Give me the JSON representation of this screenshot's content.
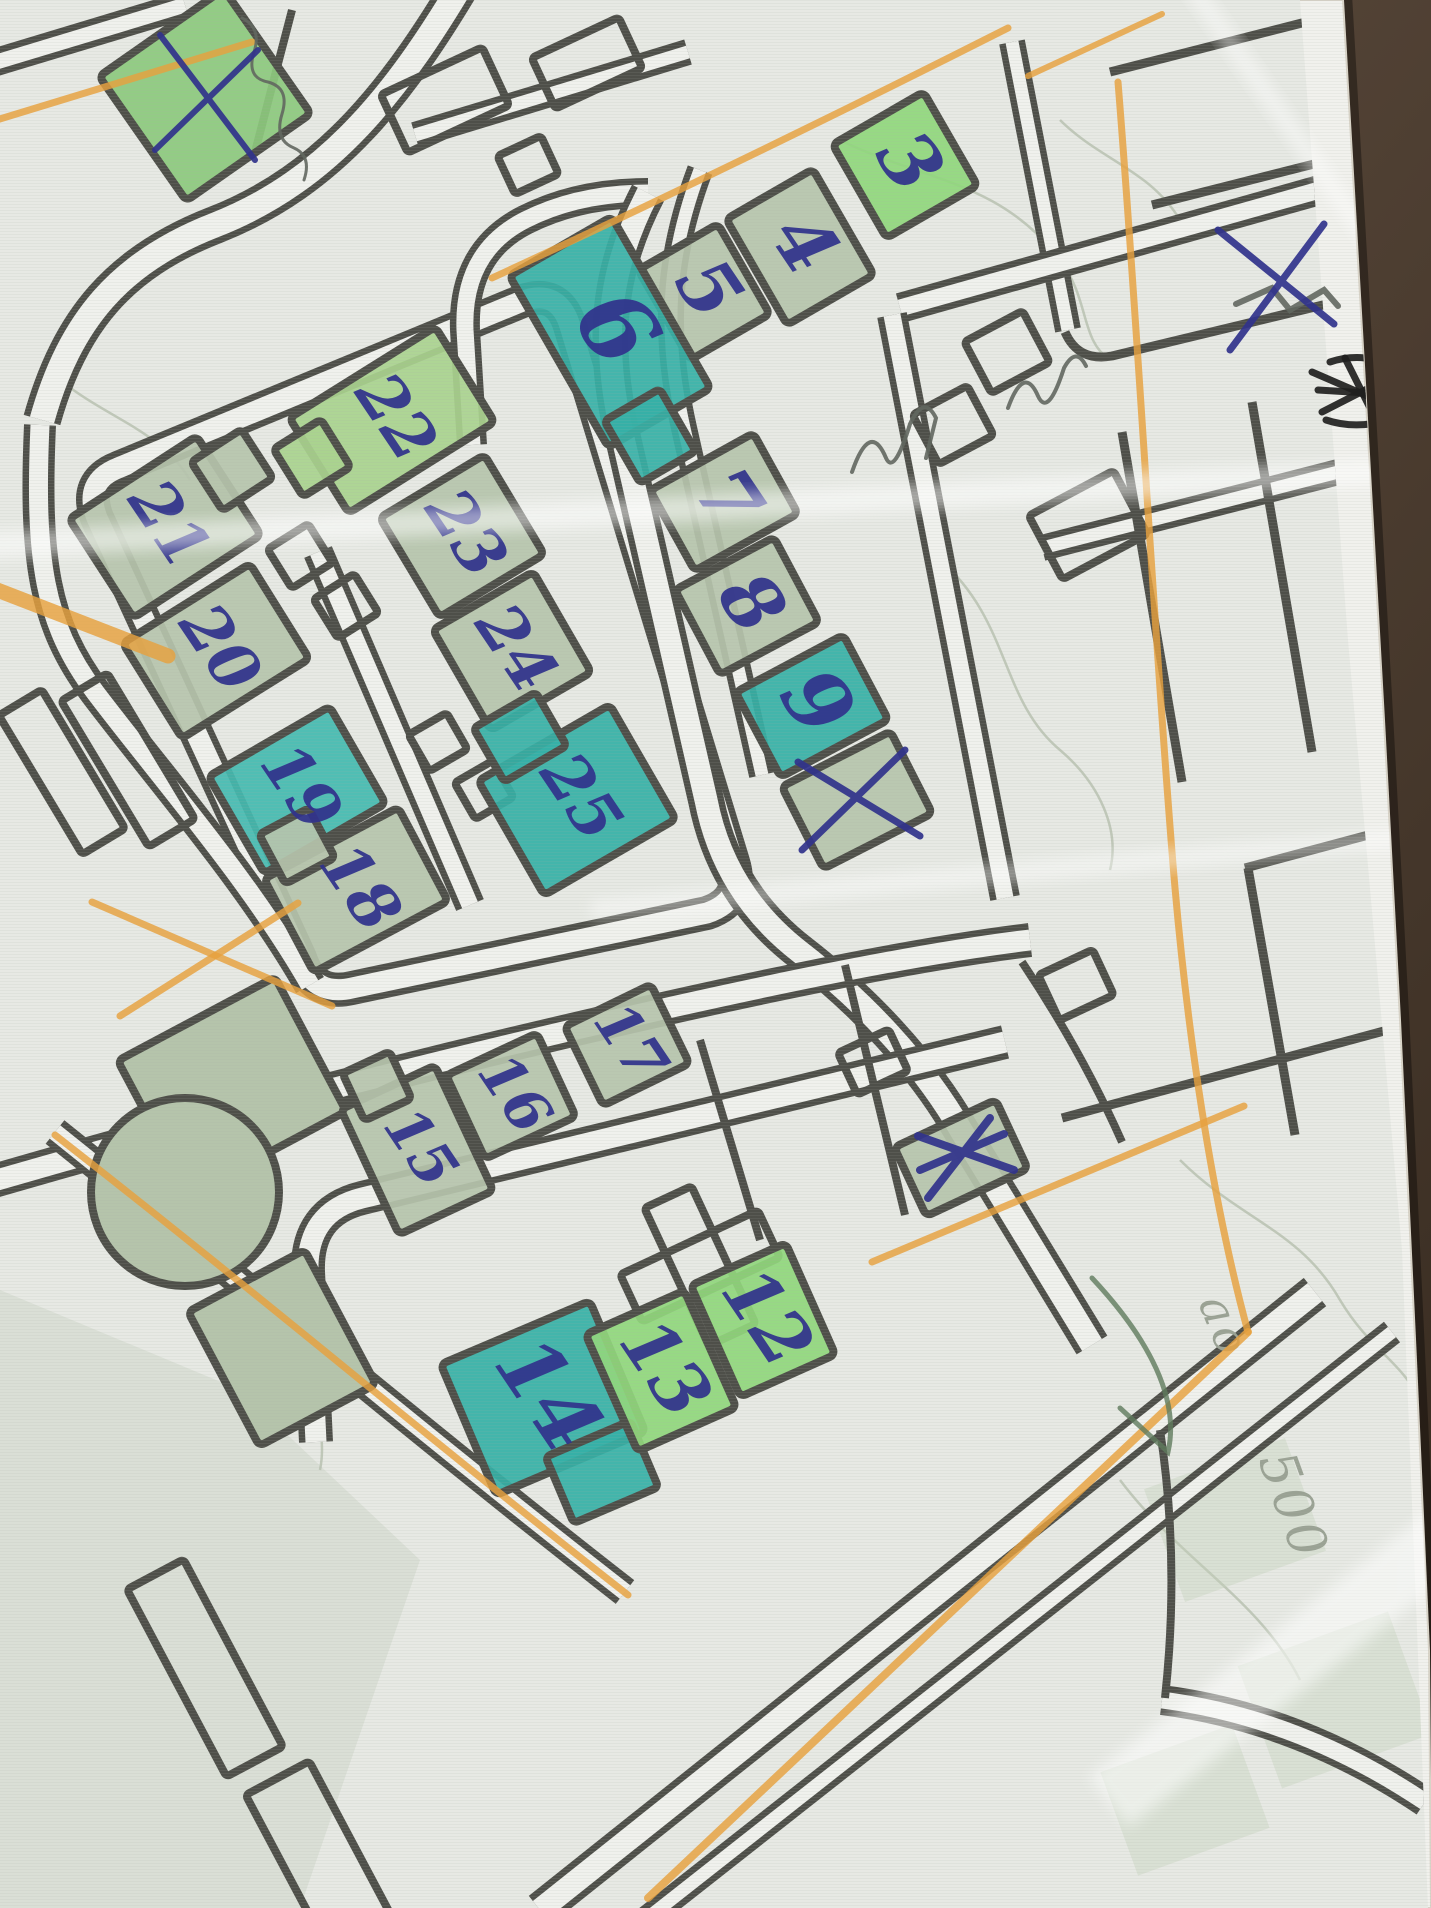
{
  "meta": {
    "description_label": ""
  },
  "scene": {
    "width": 1431,
    "height": 1908,
    "table_color_light": "#6b5849",
    "table_color_dark": "#35291e",
    "paper_color": "#f1f1ed",
    "map_bg": "#e7e9e4",
    "line_color": "#4e4f49",
    "road_fill": "#f0f1ed",
    "pen_color": "#31338c",
    "orange": "#e6a13e",
    "pencil": "#62675f",
    "print_gray": "#9aa294",
    "fills": {
      "pale": "#b6c4ac",
      "green": "#90d77c",
      "green2": "#a9d28e",
      "green3": "#8cc97d",
      "teal": "#35b0a6",
      "teal2": "#43bab0",
      "sage": "#b5c4ab"
    }
  },
  "paper_outline": "M 0,0 L 1343,0 L 1362,330 L 1384,720 L 1400,1020 L 1416,1360 L 1429,1650 L 1431,1908 L 0,1908 Z",
  "map_clip": "M 0,0 L 1300,0 L 1348,640 L 1402,1250 L 1428,1908 L 0,1908 Z",
  "roads": [
    {
      "d": "M 470,-30 C 400,90 330,180 215,225 C 120,262 70,320 42,420",
      "w": 38
    },
    {
      "d": "M -30,70 L 185,5",
      "w": 28
    },
    {
      "d": "M 118,468 L 520,302 Q 558,287 570,326 L 733,862 Q 745,900 707,913 L 352,988 Q 313,997 300,958 L 97,518 Q 83,482 118,468 Z",
      "w": 34
    },
    {
      "d": "M 318,552 L 470,905",
      "w": 30
    },
    {
      "d": "M 472,445 L 465,330 Q 462,252 525,220 Q 578,193 648,193",
      "w": 30
    },
    {
      "d": "M 648,193 C 612,262 600,330 620,425 L 706,800 Q 724,893 800,952 C 862,1000 922,1062 962,1132 L 1092,1345",
      "w": 36
    },
    {
      "d": "M 700,170 C 668,255 662,330 684,428 L 762,775",
      "w": 26
    },
    {
      "d": "M -20,1185 C 210,1118 430,1062 650,1012 C 800,978 930,952 1030,940",
      "w": 34
    },
    {
      "d": "M 316,1442 L 308,1272 Q 306,1212 362,1198 L 1005,1042",
      "w": 34
    },
    {
      "d": "M 1315,1292 L 540,1910",
      "w": 36
    },
    {
      "d": "M 1392,1332 L 640,1924",
      "w": 26
    },
    {
      "d": "M 415,135 L 688,52",
      "w": 26
    },
    {
      "d": "M 1012,42 L 1068,330",
      "w": 26
    },
    {
      "d": "M 900,308 L 1348,182",
      "w": 30
    },
    {
      "d": "M 892,315 L 1005,898",
      "w": 30
    },
    {
      "d": "M 1042,548 L 1432,448",
      "w": 26
    },
    {
      "d": "M 1162,1700 Q 1300,1718 1425,1802",
      "w": 30
    },
    {
      "d": "M 40,425 C 34,560 44,624 95,692 C 160,778 250,880 310,985",
      "w": 32
    },
    {
      "d": "M 55,1132 C 255,1292 420,1432 625,1592",
      "w": 30
    }
  ],
  "single_lines": [
    {
      "d": "M 1065,332 Q 1078,362 1112,356 L 1352,298",
      "w": 9
    },
    {
      "d": "M 1110,72 L 1345,12",
      "w": 9
    },
    {
      "d": "M 1152,205 L 1385,146",
      "w": 9
    },
    {
      "d": "M 1122,432 L 1182,782",
      "w": 9
    },
    {
      "d": "M 1252,402 L 1312,752",
      "w": 9
    },
    {
      "d": "M 1062,1118 L 1432,1018",
      "w": 9
    },
    {
      "d": "M 1245,868 L 1432,818",
      "w": 9
    },
    {
      "d": "M 1248,868 L 1295,1135",
      "w": 9
    },
    {
      "d": "M 292,10 L 255,152",
      "w": 8
    },
    {
      "d": "M 1022,962 Q 1082,1052 1122,1142",
      "w": 8
    },
    {
      "d": "M 845,965 L 905,1215",
      "w": 8
    },
    {
      "d": "M 700,1040 L 760,1240",
      "w": 8
    },
    {
      "d": "M 1160,1430 Q 1180,1560 1165,1698",
      "w": 8
    }
  ],
  "buildings": [
    {
      "label": "3",
      "cx": 905,
      "cy": 165,
      "w": 105,
      "h": 108,
      "rot": -30,
      "fill": "green",
      "lsize": 76
    },
    {
      "label": "4",
      "cx": 800,
      "cy": 247,
      "w": 100,
      "h": 122,
      "rot": -30,
      "fill": "pale",
      "lsize": 76
    },
    {
      "label": "5",
      "cx": 704,
      "cy": 292,
      "w": 92,
      "h": 104,
      "rot": -30,
      "fill": "pale",
      "lsize": 76
    },
    {
      "label": "6",
      "cx": 610,
      "cy": 332,
      "w": 118,
      "h": 198,
      "rot": -30,
      "fill": "teal",
      "lsize": 96,
      "ext": [
        {
          "cx": 650,
          "cy": 436,
          "w": 64,
          "h": 72
        }
      ]
    },
    {
      "label": "7",
      "cx": 724,
      "cy": 502,
      "w": 118,
      "h": 92,
      "rot": -29,
      "fill": "pale",
      "lsize": 76
    },
    {
      "label": "8",
      "cx": 747,
      "cy": 606,
      "w": 112,
      "h": 96,
      "rot": -28,
      "fill": "pale",
      "lsize": 76
    },
    {
      "label": "9",
      "cx": 812,
      "cy": 706,
      "w": 122,
      "h": 96,
      "rot": -28,
      "fill": "teal",
      "lsize": 84
    },
    {
      "label": "",
      "cx": 857,
      "cy": 800,
      "w": 122,
      "h": 92,
      "rot": -27,
      "fill": "pale"
    },
    {
      "label": "21",
      "cx": 165,
      "cy": 527,
      "w": 152,
      "h": 118,
      "rot": -33,
      "fill": "pale",
      "lsize": 64,
      "ext": [
        {
          "cx": 232,
          "cy": 470,
          "w": 60,
          "h": 58
        }
      ]
    },
    {
      "label": "22",
      "cx": 392,
      "cy": 420,
      "w": 172,
      "h": 112,
      "rot": -32,
      "fill": "green2",
      "lsize": 64,
      "ext": [
        {
          "cx": 312,
          "cy": 458,
          "w": 56,
          "h": 56
        }
      ]
    },
    {
      "label": "23",
      "cx": 462,
      "cy": 536,
      "w": 122,
      "h": 116,
      "rot": -31,
      "fill": "pale",
      "lsize": 64
    },
    {
      "label": "24",
      "cx": 512,
      "cy": 651,
      "w": 116,
      "h": 116,
      "rot": -30,
      "fill": "pale",
      "lsize": 64
    },
    {
      "label": "20",
      "cx": 216,
      "cy": 651,
      "w": 150,
      "h": 112,
      "rot": -32,
      "fill": "pale",
      "lsize": 64
    },
    {
      "label": "19",
      "cx": 297,
      "cy": 790,
      "w": 140,
      "h": 112,
      "rot": -30,
      "fill": "teal2",
      "lsize": 64
    },
    {
      "label": "25",
      "cx": 577,
      "cy": 800,
      "w": 152,
      "h": 132,
      "rot": -30,
      "fill": "teal",
      "lsize": 64,
      "ext": [
        {
          "cx": 520,
          "cy": 737,
          "w": 72,
          "h": 62
        }
      ]
    },
    {
      "label": "18",
      "cx": 356,
      "cy": 890,
      "w": 152,
      "h": 106,
      "rot": -28,
      "fill": "pale",
      "lsize": 64,
      "ext": [
        {
          "cx": 297,
          "cy": 846,
          "w": 56,
          "h": 56
        }
      ]
    },
    {
      "label": "17",
      "cx": 627,
      "cy": 1045,
      "w": 96,
      "h": 88,
      "rot": -26,
      "fill": "pale",
      "lsize": 58
    },
    {
      "label": "16",
      "cx": 511,
      "cy": 1096,
      "w": 100,
      "h": 92,
      "rot": -25,
      "fill": "pale",
      "lsize": 58
    },
    {
      "label": "15",
      "cx": 417,
      "cy": 1150,
      "w": 104,
      "h": 138,
      "rot": -25,
      "fill": "pale",
      "lsize": 58,
      "ext": [
        {
          "cx": 377,
          "cy": 1086,
          "w": 52,
          "h": 52
        }
      ]
    },
    {
      "label": "14",
      "cx": 543,
      "cy": 1398,
      "w": 162,
      "h": 142,
      "rot": -23,
      "fill": "teal",
      "lsize": 84,
      "ext": [
        {
          "cx": 602,
          "cy": 1472,
          "w": 92,
          "h": 72
        }
      ]
    },
    {
      "label": "13",
      "cx": 661,
      "cy": 1371,
      "w": 108,
      "h": 128,
      "rot": -24,
      "fill": "green",
      "lsize": 72
    },
    {
      "label": "12",
      "cx": 763,
      "cy": 1320,
      "w": 104,
      "h": 122,
      "rot": -24,
      "fill": "green",
      "lsize": 72
    },
    {
      "label": "",
      "cx": 205,
      "cy": 95,
      "w": 152,
      "h": 152,
      "rot": -35,
      "fill": "green3"
    },
    {
      "label": "",
      "cx": 961,
      "cy": 1158,
      "w": 112,
      "h": 76,
      "rot": -25,
      "fill": "pale"
    }
  ],
  "unfilled_buildings": [
    {
      "cx": 445,
      "cy": 100,
      "w": 112,
      "h": 64,
      "rot": -25
    },
    {
      "cx": 587,
      "cy": 63,
      "w": 96,
      "h": 56,
      "rot": -25
    },
    {
      "cx": 528,
      "cy": 165,
      "w": 48,
      "h": 42,
      "rot": -25
    },
    {
      "cx": 953,
      "cy": 425,
      "w": 62,
      "h": 56,
      "rot": -28
    },
    {
      "cx": 1007,
      "cy": 352,
      "w": 66,
      "h": 58,
      "rot": -28
    },
    {
      "cx": 1088,
      "cy": 525,
      "w": 96,
      "h": 72,
      "rot": -28
    },
    {
      "cx": 300,
      "cy": 556,
      "w": 48,
      "h": 46,
      "rot": -32
    },
    {
      "cx": 346,
      "cy": 606,
      "w": 48,
      "h": 46,
      "rot": -32
    },
    {
      "cx": 438,
      "cy": 742,
      "w": 44,
      "h": 42,
      "rot": -30
    },
    {
      "cx": 484,
      "cy": 790,
      "w": 44,
      "h": 42,
      "rot": -30
    },
    {
      "cx": 873,
      "cy": 1062,
      "w": 56,
      "h": 46,
      "rot": -25
    },
    {
      "cx": 1076,
      "cy": 985,
      "w": 60,
      "h": 50,
      "rot": -25
    },
    {
      "cx": 700,
      "cy": 1266,
      "w": 152,
      "h": 52,
      "rot": -25
    },
    {
      "cx": 700,
      "cy": 1266,
      "w": 52,
      "h": 152,
      "rot": -25
    },
    {
      "cx": 205,
      "cy": 1668,
      "w": 64,
      "h": 212,
      "rot": -28
    },
    {
      "cx": 322,
      "cy": 1862,
      "w": 72,
      "h": 190,
      "rot": -28
    },
    {
      "cx": 62,
      "cy": 772,
      "w": 50,
      "h": 162,
      "rot": -31
    },
    {
      "cx": 128,
      "cy": 760,
      "w": 54,
      "h": 170,
      "rot": -31
    }
  ],
  "green_areas": [
    {
      "type": "rect",
      "cx": 232,
      "cy": 1086,
      "w": 178,
      "h": 152,
      "rot": -28
    },
    {
      "type": "circle",
      "cx": 185,
      "cy": 1192,
      "r": 94
    },
    {
      "type": "rect",
      "cx": 282,
      "cy": 1348,
      "w": 132,
      "h": 152,
      "rot": -28
    }
  ],
  "faint_green": [
    {
      "cx": 1235,
      "cy": 1520,
      "w": 150,
      "h": 120,
      "rot": -20
    },
    {
      "cx": 1335,
      "cy": 1700,
      "w": 160,
      "h": 130,
      "rot": -20
    },
    {
      "cx": 1185,
      "cy": 1800,
      "w": 140,
      "h": 110,
      "rot": -20
    }
  ],
  "wash_polygon": "M 0,1290 L 240,1390 L 420,1560 L 300,1908 L 0,1908 Z",
  "contours": [
    "M 840,140 C 920,180 1000,180 1060,260 C 1090,300 1080,340 1110,360",
    "M 940,560 C 1010,620 1000,700 1060,750 C 1100,784 1120,830 1110,870",
    "M 60,380 C 110,420 160,430 190,480",
    "M 120,1180 C 160,1240 200,1260 260,1320 C 300,1360 330,1420 320,1470",
    "M 1180,1160 C 1240,1220 1300,1230 1340,1300 C 1370,1350 1400,1360 1420,1400",
    "M 1060,120 C 1100,160 1150,170 1180,220",
    "M 120,1140 C 170,1120 230,1130 266,1168",
    "M 1120,1480 C 1180,1560 1260,1600 1300,1680"
  ],
  "annotations": {
    "orange_lines": [
      {
        "d": "M 252,42 L -10,122",
        "w": 7
      },
      {
        "d": "M 1008,28 C 830,118 640,210 492,278",
        "w": 7
      },
      {
        "d": "M 1162,14 L 1028,76",
        "w": 6
      },
      {
        "d": "M -8,588 L 168,656",
        "w": 15
      },
      {
        "d": "M 92,902 L 332,1006",
        "w": 7
      },
      {
        "d": "M 298,903 L 120,1016",
        "w": 7
      },
      {
        "d": "M 55,1135 C 260,1295 430,1440 628,1595",
        "w": 7
      },
      {
        "d": "M 1118,82 C 1138,330 1152,600 1172,852 C 1186,1030 1212,1200 1248,1332",
        "w": 7
      },
      {
        "d": "M 1248,1332 L 648,1898",
        "w": 8
      },
      {
        "d": "M 1244,1106 L 872,1262",
        "w": 7
      }
    ],
    "pen_x_marks": [
      {
        "w": 6,
        "pts": [
          [
            160,
            35,
            255,
            160
          ],
          [
            258,
            50,
            155,
            150
          ]
        ]
      },
      {
        "w": 7,
        "pts": [
          [
            798,
            762,
            920,
            836
          ],
          [
            905,
            750,
            802,
            850
          ]
        ]
      },
      {
        "w": 8,
        "pts": [
          [
            918,
            1136,
            1014,
            1170
          ],
          [
            990,
            1118,
            928,
            1198
          ],
          [
            920,
            1170,
            1004,
            1134
          ]
        ]
      },
      {
        "w": 7,
        "pts": [
          [
            1218,
            230,
            1334,
            324
          ],
          [
            1324,
            224,
            1230,
            350
          ]
        ]
      }
    ],
    "pencil_scribbles": [
      {
        "d": "M 852,472 q 18,-52 34,-14 q 8,18 24,-34 q 14,-30 26,-6 l -10,40",
        "w": 4
      },
      {
        "d": "M 1008,408 q 16,-44 30,-12 q 10,22 26,-28 q 12,-22 22,-2",
        "w": 4
      },
      {
        "d": "M 242,18 q 20,10 12,34 q -8,26 14,30 q 22,6 14,32 q -8,26 12,34 q 18,8 10,32",
        "w": 3
      },
      {
        "d": "M 1236,304 l 36,-16 l 18,22 l 34,-20 l 14,16",
        "w": 6
      }
    ],
    "black_scribble": [
      "M 1312,372 L 1418,418",
      "M 1322,412 L 1412,366",
      "M 1318,390 L 1415,396",
      "M 1345,358 L 1382,432",
      "M 1330,362 C 1360,352 1390,360 1408,376",
      "M 1326,420 C 1356,430 1390,424 1412,408"
    ],
    "green_pencil": "M 1092,1278 C 1150,1340 1180,1400 1168,1452 L 1120,1408",
    "gray_labels": [
      {
        "text": "ao",
        "x": 1210,
        "y": 1332,
        "rot": 68,
        "size": 46
      },
      {
        "text": "500",
        "x": 1277,
        "y": 1512,
        "rot": 70,
        "size": 52
      }
    ]
  },
  "creases": [
    {
      "x": 700,
      "y": 508,
      "w": 1480,
      "h": 26,
      "rot": -3,
      "o": 0.5
    },
    {
      "x": 1020,
      "y": 872,
      "w": 860,
      "h": 20,
      "rot": -5,
      "o": 0.42
    },
    {
      "x": 1290,
      "y": 1660,
      "w": 460,
      "h": 64,
      "rot": -38,
      "o": 0.5
    },
    {
      "x": 1285,
      "y": 120,
      "w": 340,
      "h": 18,
      "rot": 55,
      "o": 0.45
    }
  ]
}
